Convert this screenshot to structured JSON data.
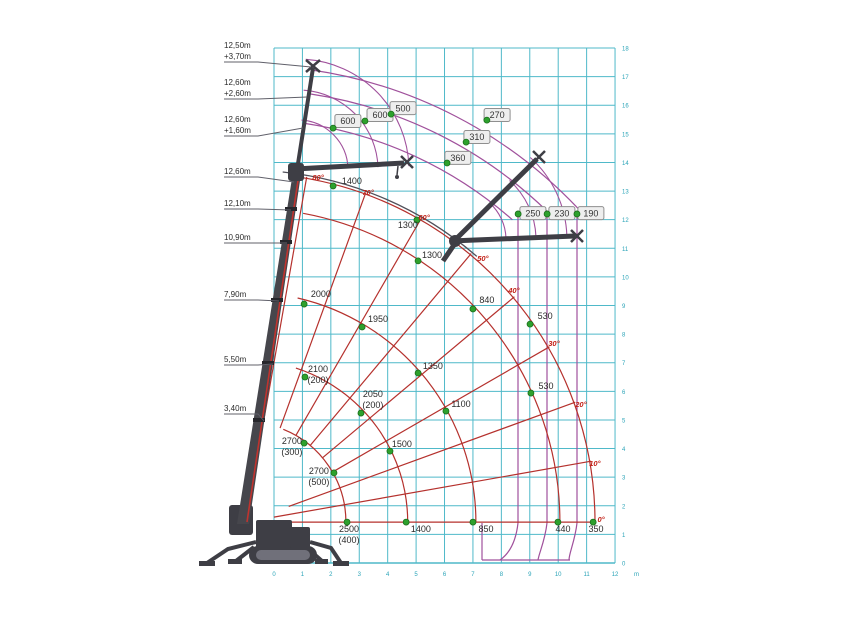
{
  "chart_data": {
    "type": "crane-load-chart",
    "axes": {
      "x": {
        "unit": "m",
        "min": 0,
        "max": 12,
        "ticks": [
          0,
          1,
          2,
          3,
          4,
          5,
          6,
          7,
          8,
          9,
          10,
          11,
          12
        ]
      },
      "y": {
        "unit": "m",
        "min": 0,
        "max": 18,
        "ticks": [
          0,
          1,
          2,
          3,
          4,
          5,
          6,
          7,
          8,
          9,
          10,
          11,
          12,
          13,
          14,
          15,
          16,
          17,
          18
        ]
      }
    },
    "colors": {
      "grid": "#4fb9c9",
      "tick_text": "#2ba4b8",
      "red_curve": "#b5312d",
      "angle_text": "#c22016",
      "purple_curve": "#a0519c",
      "dark_curve": "#50505a",
      "green_dot": "#2da12d",
      "green_dot_border": "#1c6e1c",
      "value_text": "#2b2b2b",
      "box_fill": "#eeeeee",
      "box_border": "#8f8f8f",
      "crane_body": "#3e3e45",
      "crane_accent": "#c0332e",
      "leader_line": "#60606a"
    },
    "pivot": {
      "x_m": -0.99,
      "y_m": 1.43
    },
    "boom_config_labels": [
      {
        "lines": [
          "12,50m",
          "+3,70m"
        ],
        "x": 224,
        "y": 48,
        "tx": 311,
        "ty": 67
      },
      {
        "lines": [
          "12,60m",
          "+2,60m"
        ],
        "x": 224,
        "y": 85,
        "tx": 307,
        "ty": 97
      },
      {
        "lines": [
          "12,60m",
          "+1,60m"
        ],
        "x": 224,
        "y": 122,
        "tx": 303,
        "ty": 128
      },
      {
        "lines": [
          "12,60m"
        ],
        "x": 224,
        "y": 174,
        "tx": 294,
        "ty": 182
      },
      {
        "lines": [
          "12,10m"
        ],
        "x": 224,
        "y": 206,
        "tx": 291,
        "ty": 210
      },
      {
        "lines": [
          "10,90m"
        ],
        "x": 224,
        "y": 240,
        "tx": 287,
        "ty": 243
      },
      {
        "lines": [
          "7,90m"
        ],
        "x": 224,
        "y": 297,
        "tx": 279,
        "ty": 301
      },
      {
        "lines": [
          "5,50m"
        ],
        "x": 224,
        "y": 362,
        "tx": 273,
        "ty": 364
      },
      {
        "lines": [
          "3,40m"
        ],
        "x": 224,
        "y": 411,
        "tx": 264,
        "ty": 421
      }
    ],
    "jib_capacity_points": [
      {
        "load": "600",
        "dot": [
          2.08,
          15.2
        ],
        "box": [
          2.6,
          15.45
        ]
      },
      {
        "load": "600",
        "dot": [
          3.2,
          15.45
        ],
        "box": [
          3.73,
          15.66
        ]
      },
      {
        "load": "500",
        "dot": [
          4.12,
          15.69
        ],
        "box": [
          4.54,
          15.9
        ]
      },
      {
        "load": "270",
        "dot": [
          7.49,
          15.48
        ],
        "box": [
          7.85,
          15.66
        ]
      },
      {
        "load": "310",
        "dot": [
          6.76,
          14.71
        ],
        "box": [
          7.14,
          14.89
        ]
      },
      {
        "load": "360",
        "dot": [
          6.09,
          13.98
        ],
        "box": [
          6.47,
          14.16
        ]
      },
      {
        "load": "250",
        "dot": [
          8.59,
          12.2
        ],
        "box": [
          9.11,
          12.23
        ]
      },
      {
        "load": "230",
        "dot": [
          9.61,
          12.2
        ],
        "box": [
          10.13,
          12.23
        ]
      },
      {
        "load": "190",
        "dot": [
          10.66,
          12.2
        ],
        "box": [
          11.15,
          12.23
        ]
      }
    ],
    "boom_capacity_points": [
      {
        "load": "1400",
        "note": "",
        "dot": [
          2.08,
          13.18
        ],
        "text": [
          2.74,
          13.25
        ]
      },
      {
        "load": "1300",
        "note": "",
        "dot": [
          5.03,
          11.99
        ],
        "text": [
          4.71,
          11.71
        ]
      },
      {
        "load": "1300",
        "note": "",
        "dot": [
          5.07,
          10.56
        ],
        "text": [
          5.56,
          10.66
        ]
      },
      {
        "load": "2000",
        "note": "",
        "dot": [
          1.06,
          9.05
        ],
        "text": [
          1.65,
          9.3
        ]
      },
      {
        "load": "1950",
        "note": "",
        "dot": [
          3.1,
          8.25
        ],
        "text": [
          3.66,
          8.42
        ]
      },
      {
        "load": "840",
        "note": "",
        "dot": [
          7.0,
          8.88
        ],
        "text": [
          7.49,
          9.09
        ]
      },
      {
        "load": "530",
        "note": "",
        "dot": [
          9.01,
          8.35
        ],
        "text": [
          9.54,
          8.53
        ]
      },
      {
        "load": "2100",
        "note": "(200)",
        "dot": [
          1.09,
          6.5
        ],
        "text": [
          1.55,
          6.68
        ]
      },
      {
        "load": "1350",
        "note": "",
        "dot": [
          5.07,
          6.64
        ],
        "text": [
          5.59,
          6.78
        ]
      },
      {
        "load": "530",
        "note": "",
        "dot": [
          9.04,
          5.94
        ],
        "text": [
          9.57,
          6.08
        ]
      },
      {
        "load": "2050",
        "note": "(200)",
        "dot": [
          3.06,
          5.24
        ],
        "text": [
          3.48,
          5.8
        ]
      },
      {
        "load": "1100",
        "note": "",
        "dot": [
          6.05,
          5.31
        ],
        "text": [
          6.58,
          5.45
        ]
      },
      {
        "load": "2700",
        "note": "(300)",
        "dot": [
          1.06,
          4.19
        ],
        "text": [
          0.63,
          4.16
        ]
      },
      {
        "load": "1500",
        "note": "",
        "dot": [
          4.08,
          3.91
        ],
        "text": [
          4.5,
          4.05
        ]
      },
      {
        "load": "2700",
        "note": "(500)",
        "dot": [
          2.11,
          3.15
        ],
        "text": [
          1.58,
          3.11
        ]
      },
      {
        "load": "2500",
        "note": "(400)",
        "dot": [
          2.57,
          1.43
        ],
        "text": [
          2.64,
          1.08
        ]
      },
      {
        "load": "1400",
        "note": "",
        "dot": [
          4.65,
          1.43
        ],
        "text": [
          5.17,
          1.08
        ]
      },
      {
        "load": "850",
        "note": "",
        "dot": [
          7.0,
          1.43
        ],
        "text": [
          7.46,
          1.08
        ]
      },
      {
        "load": "440",
        "note": "",
        "dot": [
          9.99,
          1.43
        ],
        "text": [
          10.17,
          1.08
        ]
      },
      {
        "load": "350",
        "note": "",
        "dot": [
          11.23,
          1.43
        ],
        "text": [
          11.33,
          1.08
        ]
      }
    ],
    "angle_labels": [
      {
        "text": "0°",
        "pos": [
          11.51,
          1.54
        ]
      },
      {
        "text": "10°",
        "pos": [
          11.29,
          3.5
        ]
      },
      {
        "text": "20°",
        "pos": [
          10.8,
          5.56
        ]
      },
      {
        "text": "30°",
        "pos": [
          9.85,
          7.69
        ]
      },
      {
        "text": "40°",
        "pos": [
          8.44,
          9.54
        ]
      },
      {
        "text": "50°",
        "pos": [
          7.35,
          10.66
        ]
      },
      {
        "text": "60°",
        "pos": [
          5.28,
          12.09
        ]
      },
      {
        "text": "70°",
        "pos": [
          3.31,
          12.97
        ]
      },
      {
        "text": "80°",
        "pos": [
          1.55,
          13.49
        ]
      }
    ],
    "red_radials": [
      {
        "a": 0,
        "r0": 0.9,
        "r1": 12.25
      },
      {
        "a": 10,
        "r0": 1.0,
        "r1": 12.3
      },
      {
        "a": 20,
        "r0": 1.6,
        "r1": 12.3
      },
      {
        "a": 30,
        "r0": 3.51,
        "r1": 12.3
      },
      {
        "a": 40,
        "r0": 3.51,
        "r1": 12.3
      },
      {
        "a": 50,
        "r0": 3.51,
        "r1": 12.3
      },
      {
        "a": 60,
        "r0": 3.51,
        "r1": 12.3
      },
      {
        "a": 70,
        "r0": 3.51,
        "r1": 12.3
      },
      {
        "a": 80,
        "r0": 3.51,
        "r1": 12.3
      }
    ],
    "red_arcs": [
      {
        "r": 3.51,
        "a0": 0,
        "a1": 68
      },
      {
        "r": 5.68,
        "a0": 0,
        "a1": 72
      },
      {
        "r": 8.07,
        "a0": 0,
        "a1": 77
      },
      {
        "r": 11.02,
        "a0": 0,
        "a1": 79.5
      },
      {
        "r": 12.25,
        "a0": 0,
        "a1": 81
      }
    ],
    "purple_arcs": [
      {
        "r": 14.14,
        "a0": 48.6,
        "a1": 81.5
      },
      {
        "r": 15.19,
        "a0": 45.7,
        "a1": 81.5
      },
      {
        "r": 16.03,
        "a0": 43.4,
        "a1": 81.8
      }
    ],
    "dark_arcs": [
      {
        "r": 12.35,
        "a0": 49,
        "a1": 84
      }
    ],
    "purple_fans": [
      {
        "cx": 298,
        "cy": 170,
        "radii": [
          50,
          80,
          111
        ],
        "a0": 2,
        "a1": 86
      },
      {
        "cx": 456,
        "cy": 240,
        "radii": [
          50,
          80,
          111
        ],
        "a0": 2,
        "a1": 48
      }
    ],
    "purple_drops": {
      "verticals": [
        {
          "x": 518,
          "ytop": 215,
          "xend": 500
        },
        {
          "x": 547,
          "ytop": 215,
          "xend": 538
        },
        {
          "x": 577,
          "ytop": 215,
          "xend": 569
        }
      ],
      "left_edge": {
        "x": 482,
        "ytop": 523
      },
      "bottom": {
        "x1": 482,
        "x2": 570,
        "y": 560
      }
    },
    "unit_label": "m"
  }
}
